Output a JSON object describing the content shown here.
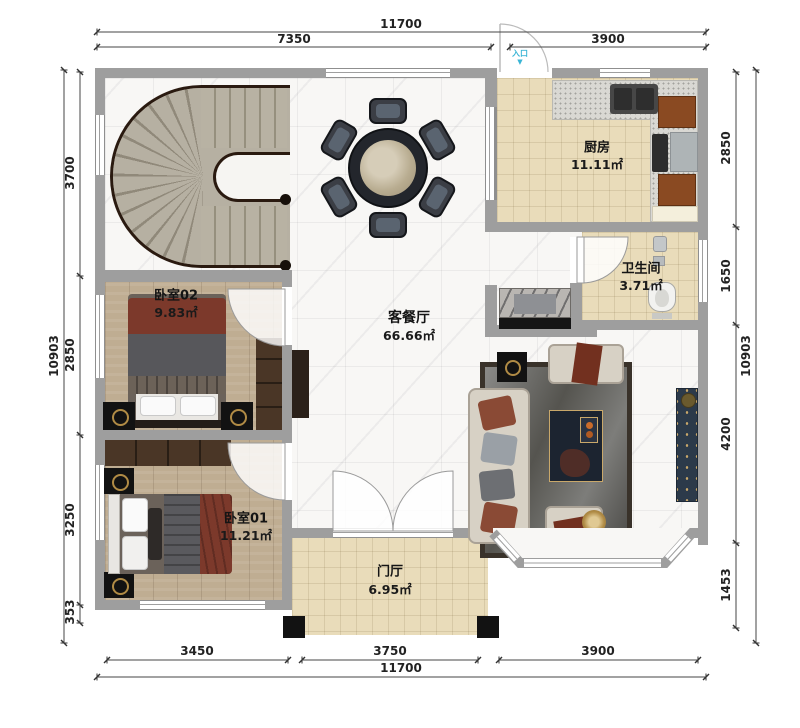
{
  "plan": {
    "entry_label": "入口",
    "entry_arrow": "▼",
    "rooms": {
      "kitchen": {
        "name": "厨房",
        "area": "11.11㎡"
      },
      "bathroom": {
        "name": "卫生间",
        "area": "3.71㎡"
      },
      "living_dining": {
        "name": "客餐厅",
        "area": "66.66㎡"
      },
      "bedroom02": {
        "name": "卧室02",
        "area": "9.83㎡"
      },
      "bedroom01": {
        "name": "卧室01",
        "area": "11.21㎡"
      },
      "foyer": {
        "name": "门厅",
        "area": "6.95㎡"
      }
    },
    "dimensions": {
      "top_total": "11700",
      "top_left": "7350",
      "top_right": "3900",
      "bottom_left": "3450",
      "bottom_center": "3750",
      "bottom_right": "3900",
      "bottom_total": "11700",
      "left_total": "10903",
      "left_1": "3700",
      "left_2": "2850",
      "left_3": "3250",
      "left_4": "353",
      "right_total": "10903",
      "right_1": "2850",
      "right_2": "1650",
      "right_3": "4200",
      "right_4": "1453"
    },
    "colors": {
      "wall": "#9e9e9e",
      "tile": "#e9dcba",
      "marble": "#f8f7f5",
      "wood": "#bfad92",
      "entry_accent": "#3ab5d5",
      "cabinet_brown": "#8a4a22"
    }
  }
}
